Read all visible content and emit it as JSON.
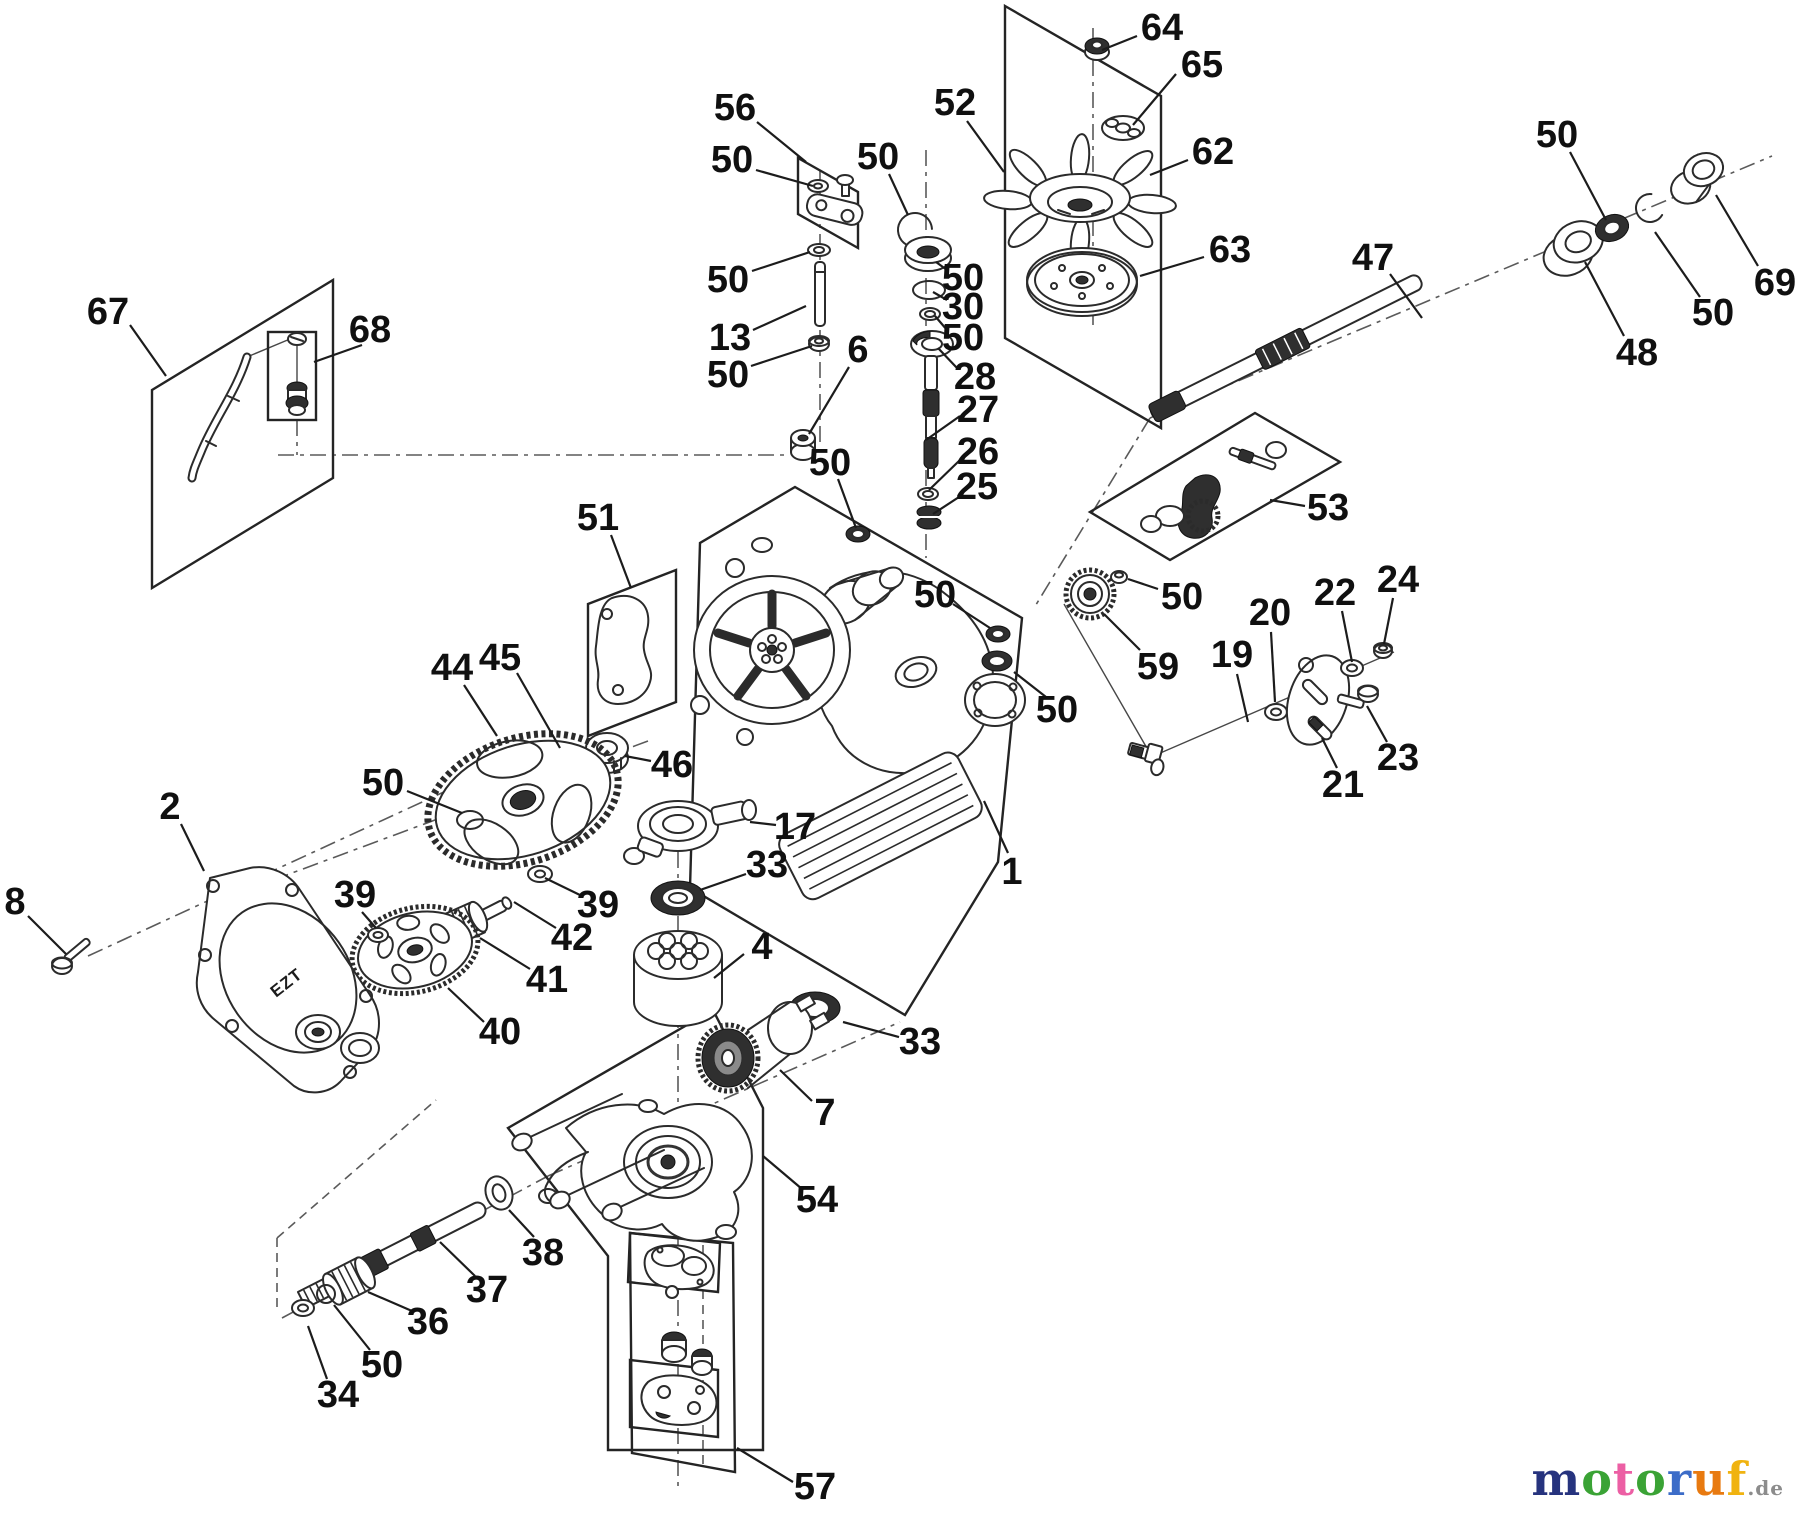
{
  "page": {
    "background": "#ffffff",
    "ink": "#2b2b2b"
  },
  "watermark": {
    "letters": [
      {
        "ch": "m",
        "color": "#26337e"
      },
      {
        "ch": "o",
        "color": "#3aa335"
      },
      {
        "ch": "t",
        "color": "#ec5fa4"
      },
      {
        "ch": "o",
        "color": "#3aa335"
      },
      {
        "ch": "r",
        "color": "#3c6cc8"
      },
      {
        "ch": "u",
        "color": "#e87a10"
      },
      {
        "ch": "f",
        "color": "#f0b310"
      }
    ],
    "suffix": ".de",
    "suffix_style": "color:#8c8c8c"
  },
  "diagram": {
    "cover_text": "EZT",
    "callouts": [
      {
        "t": "64",
        "x": 1162,
        "y": 28,
        "l": [
          1137,
          36,
          1102,
          50
        ]
      },
      {
        "t": "65",
        "x": 1202,
        "y": 65,
        "l": [
          1176,
          74,
          1133,
          125
        ]
      },
      {
        "t": "52",
        "x": 955,
        "y": 103,
        "l": [
          967,
          121,
          1004,
          172
        ]
      },
      {
        "t": "62",
        "x": 1213,
        "y": 152,
        "l": [
          1188,
          160,
          1150,
          175
        ]
      },
      {
        "t": "63",
        "x": 1230,
        "y": 250,
        "l": [
          1204,
          257,
          1140,
          276
        ]
      },
      {
        "t": "56",
        "x": 735,
        "y": 108,
        "l": [
          757,
          122,
          806,
          162
        ]
      },
      {
        "t": "50",
        "x": 732,
        "y": 160,
        "l": [
          756,
          170,
          813,
          186
        ]
      },
      {
        "t": "50",
        "x": 878,
        "y": 157,
        "l": [
          889,
          174,
          908,
          215
        ]
      },
      {
        "t": "50",
        "x": 1557,
        "y": 135,
        "l": [
          1570,
          152,
          1606,
          220
        ]
      },
      {
        "t": "69",
        "x": 1775,
        "y": 283,
        "l": [
          1758,
          266,
          1716,
          195
        ]
      },
      {
        "t": "50",
        "x": 1713,
        "y": 313,
        "l": [
          1700,
          297,
          1655,
          232
        ]
      },
      {
        "t": "48",
        "x": 1637,
        "y": 353,
        "l": [
          1624,
          336,
          1585,
          262
        ]
      },
      {
        "t": "47",
        "x": 1373,
        "y": 258,
        "l": [
          1390,
          274,
          1422,
          318
        ]
      },
      {
        "t": "50",
        "x": 728,
        "y": 280,
        "l": [
          752,
          271,
          810,
          252
        ]
      },
      {
        "t": "13",
        "x": 730,
        "y": 338,
        "l": [
          753,
          330,
          806,
          306
        ]
      },
      {
        "t": "50",
        "x": 728,
        "y": 375,
        "l": [
          751,
          366,
          812,
          346
        ]
      },
      {
        "t": "6",
        "x": 858,
        "y": 350,
        "l": [
          849,
          367,
          809,
          434
        ]
      },
      {
        "t": "50",
        "x": 963,
        "y": 278,
        "l": [
          947,
          270,
          936,
          262
        ]
      },
      {
        "t": "30",
        "x": 963,
        "y": 307,
        "l": [
          947,
          300,
          933,
          292
        ]
      },
      {
        "t": "50",
        "x": 963,
        "y": 338,
        "l": [
          947,
          330,
          935,
          316
        ]
      },
      {
        "t": "28",
        "x": 975,
        "y": 377,
        "l": [
          957,
          368,
          938,
          348
        ]
      },
      {
        "t": "27",
        "x": 978,
        "y": 410,
        "l": [
          960,
          416,
          926,
          440
        ]
      },
      {
        "t": "26",
        "x": 978,
        "y": 452,
        "l": [
          960,
          460,
          929,
          490
        ]
      },
      {
        "t": "25",
        "x": 977,
        "y": 487,
        "l": [
          959,
          497,
          933,
          514
        ]
      },
      {
        "t": "67",
        "x": 108,
        "y": 312,
        "l": [
          130,
          325,
          166,
          376
        ]
      },
      {
        "t": "68",
        "x": 370,
        "y": 330,
        "l": [
          362,
          345,
          314,
          362
        ]
      },
      {
        "t": "51",
        "x": 598,
        "y": 518,
        "l": [
          611,
          535,
          631,
          588
        ]
      },
      {
        "t": "50",
        "x": 830,
        "y": 463,
        "l": [
          838,
          479,
          856,
          528
        ]
      },
      {
        "t": "53",
        "x": 1328,
        "y": 508,
        "l": [
          1305,
          506,
          1270,
          500
        ]
      },
      {
        "t": "50",
        "x": 1182,
        "y": 597,
        "l": [
          1158,
          589,
          1128,
          579
        ]
      },
      {
        "t": "59",
        "x": 1158,
        "y": 667,
        "l": [
          1140,
          650,
          1104,
          614
        ]
      },
      {
        "t": "19",
        "x": 1232,
        "y": 655,
        "l": [
          1237,
          674,
          1248,
          722
        ]
      },
      {
        "t": "20",
        "x": 1270,
        "y": 613,
        "l": [
          1271,
          632,
          1275,
          702
        ]
      },
      {
        "t": "22",
        "x": 1335,
        "y": 593,
        "l": [
          1342,
          611,
          1352,
          662
        ]
      },
      {
        "t": "24",
        "x": 1398,
        "y": 580,
        "l": [
          1393,
          598,
          1384,
          644
        ]
      },
      {
        "t": "21",
        "x": 1343,
        "y": 785,
        "l": [
          1337,
          768,
          1322,
          738
        ]
      },
      {
        "t": "23",
        "x": 1398,
        "y": 758,
        "l": [
          1387,
          742,
          1367,
          706
        ]
      },
      {
        "t": "50",
        "x": 935,
        "y": 595,
        "l": [
          953,
          604,
          990,
          628
        ]
      },
      {
        "t": "50",
        "x": 1057,
        "y": 710,
        "l": [
          1046,
          697,
          1014,
          672
        ]
      },
      {
        "t": "1",
        "x": 1012,
        "y": 872,
        "l": [
          1008,
          853,
          984,
          801
        ]
      },
      {
        "t": "44",
        "x": 452,
        "y": 668,
        "l": [
          464,
          685,
          497,
          736
        ]
      },
      {
        "t": "45",
        "x": 500,
        "y": 658,
        "l": [
          517,
          673,
          560,
          748
        ]
      },
      {
        "t": "46",
        "x": 672,
        "y": 765,
        "l": [
          651,
          761,
          625,
          756
        ]
      },
      {
        "t": "50",
        "x": 383,
        "y": 783,
        "l": [
          407,
          791,
          462,
          813
        ]
      },
      {
        "t": "2",
        "x": 170,
        "y": 807,
        "l": [
          181,
          824,
          204,
          871
        ]
      },
      {
        "t": "8",
        "x": 15,
        "y": 902,
        "l": [
          28,
          916,
          66,
          954
        ]
      },
      {
        "t": "39",
        "x": 355,
        "y": 895,
        "l": [
          362,
          912,
          376,
          928
        ]
      },
      {
        "t": "39",
        "x": 598,
        "y": 905,
        "l": [
          582,
          896,
          545,
          878
        ]
      },
      {
        "t": "42",
        "x": 572,
        "y": 938,
        "l": [
          556,
          928,
          514,
          902
        ]
      },
      {
        "t": "41",
        "x": 547,
        "y": 980,
        "l": [
          530,
          969,
          480,
          938
        ]
      },
      {
        "t": "40",
        "x": 500,
        "y": 1032,
        "l": [
          484,
          1022,
          448,
          988
        ]
      },
      {
        "t": "17",
        "x": 795,
        "y": 827,
        "l": [
          776,
          825,
          750,
          822
        ]
      },
      {
        "t": "33",
        "x": 767,
        "y": 865,
        "l": [
          746,
          874,
          700,
          890
        ]
      },
      {
        "t": "4",
        "x": 762,
        "y": 947,
        "l": [
          744,
          954,
          714,
          978
        ]
      },
      {
        "t": "33",
        "x": 920,
        "y": 1042,
        "l": [
          899,
          1037,
          843,
          1022
        ]
      },
      {
        "t": "7",
        "x": 825,
        "y": 1113,
        "l": [
          812,
          1101,
          780,
          1070
        ]
      },
      {
        "t": "54",
        "x": 817,
        "y": 1200,
        "l": [
          802,
          1189,
          763,
          1156
        ]
      },
      {
        "t": "38",
        "x": 543,
        "y": 1253,
        "l": [
          534,
          1237,
          509,
          1210
        ]
      },
      {
        "t": "37",
        "x": 487,
        "y": 1290,
        "l": [
          475,
          1276,
          440,
          1242
        ]
      },
      {
        "t": "36",
        "x": 428,
        "y": 1322,
        "l": [
          412,
          1311,
          368,
          1292
        ]
      },
      {
        "t": "50",
        "x": 382,
        "y": 1365,
        "l": [
          370,
          1350,
          334,
          1305
        ]
      },
      {
        "t": "34",
        "x": 338,
        "y": 1395,
        "l": [
          327,
          1379,
          308,
          1326
        ]
      },
      {
        "t": "57",
        "x": 815,
        "y": 1487,
        "l": [
          793,
          1482,
          737,
          1448
        ]
      }
    ]
  }
}
